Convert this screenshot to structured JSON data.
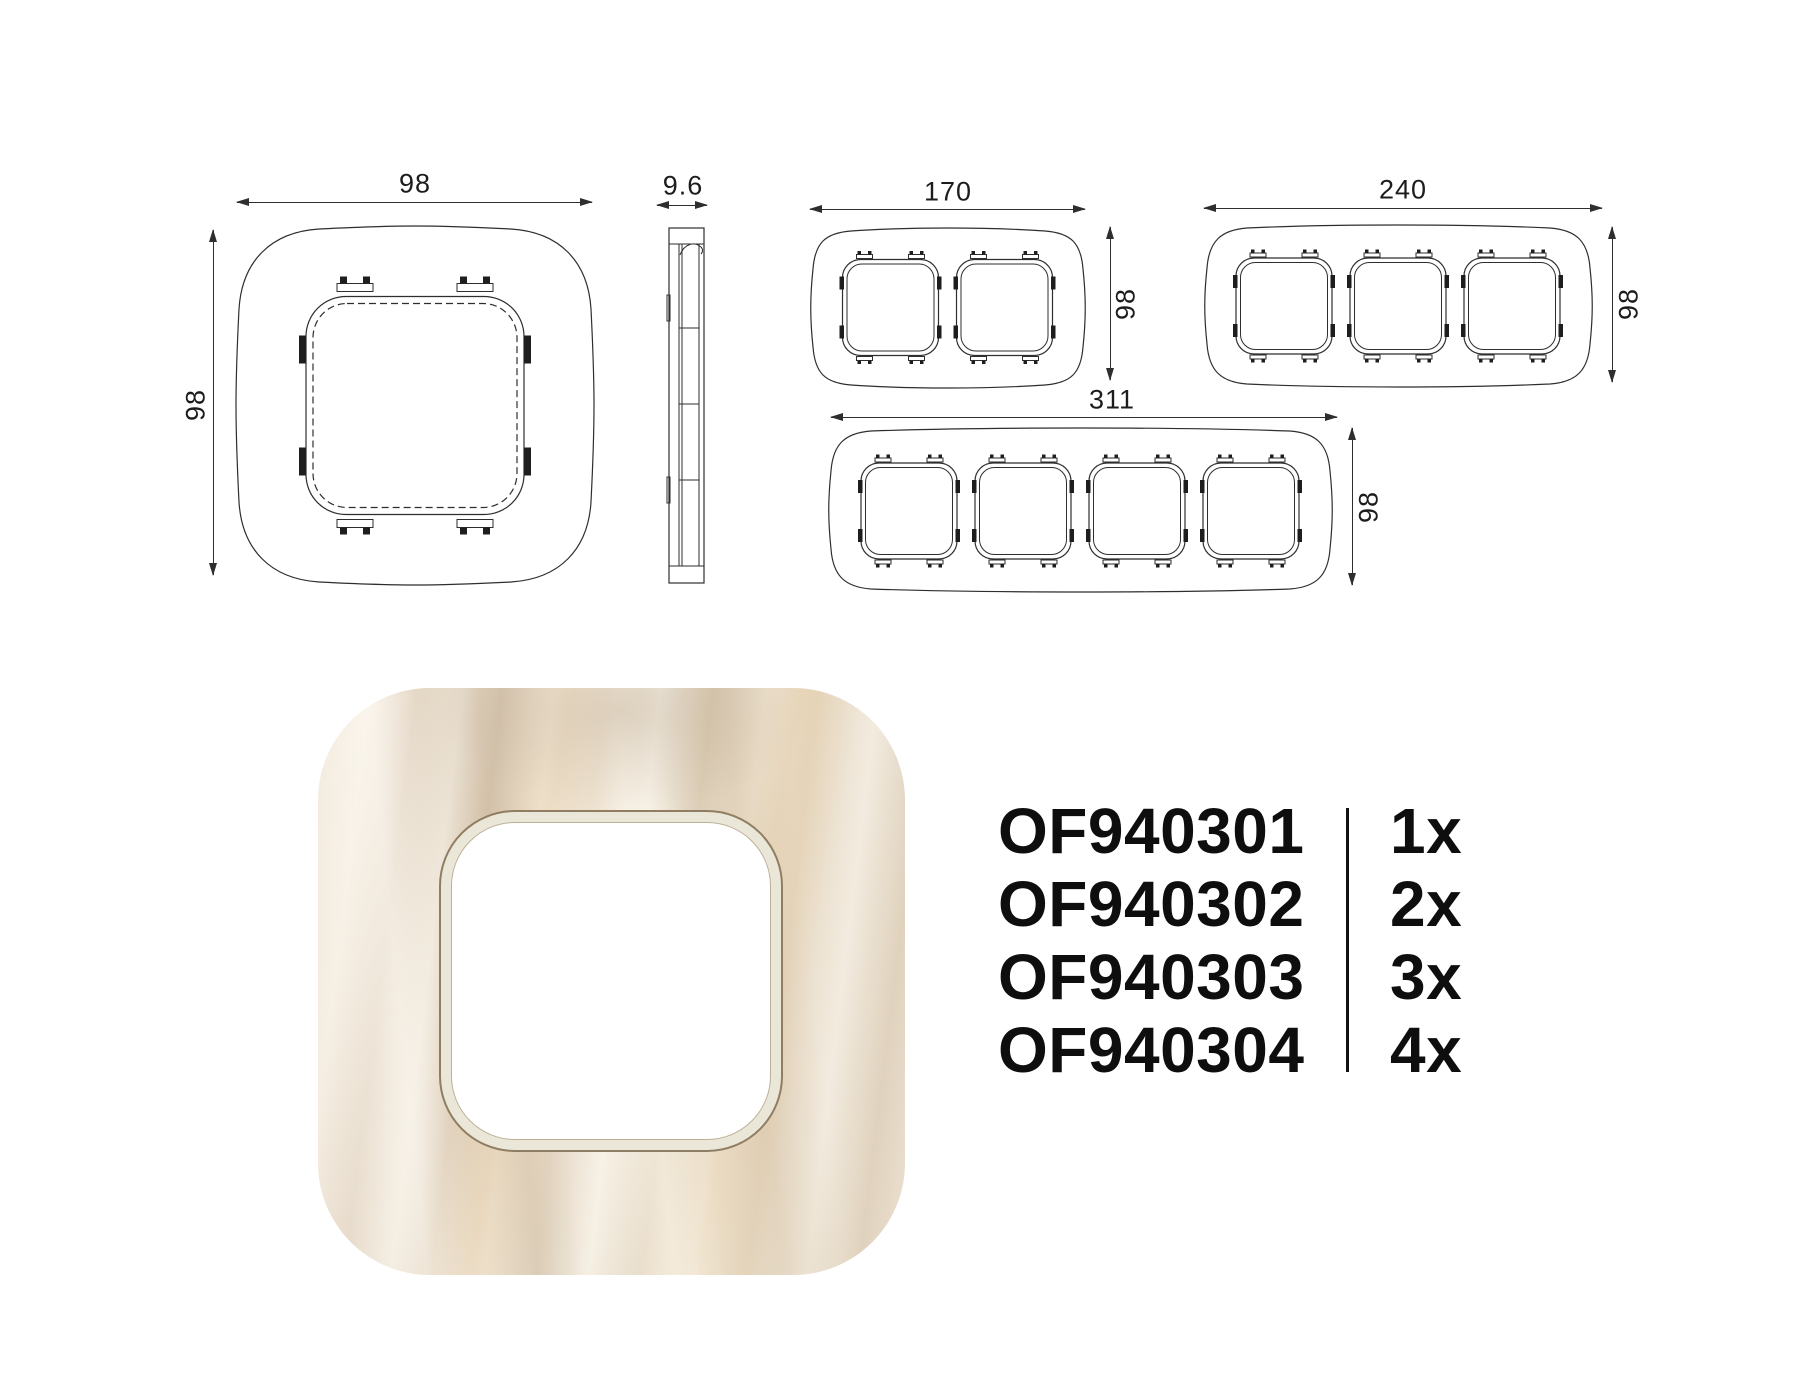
{
  "dimensions": {
    "single_width": "98",
    "single_height": "98",
    "side_depth": "9.6",
    "double_width": "170",
    "double_height": "98",
    "triple_width": "240",
    "triple_height": "98",
    "quad_width": "311",
    "quad_height": "98"
  },
  "products": [
    {
      "code": "OF940301",
      "qty": "1x"
    },
    {
      "code": "OF940302",
      "qty": "2x"
    },
    {
      "code": "OF940303",
      "qty": "3x"
    },
    {
      "code": "OF940304",
      "qty": "4x"
    }
  ],
  "colors": {
    "line": "#2e2e2e",
    "text": "#111111",
    "render_base": "#ece2d4",
    "render_rim": "#ebe7d8",
    "render_rim_edge": "#8f7e63"
  }
}
